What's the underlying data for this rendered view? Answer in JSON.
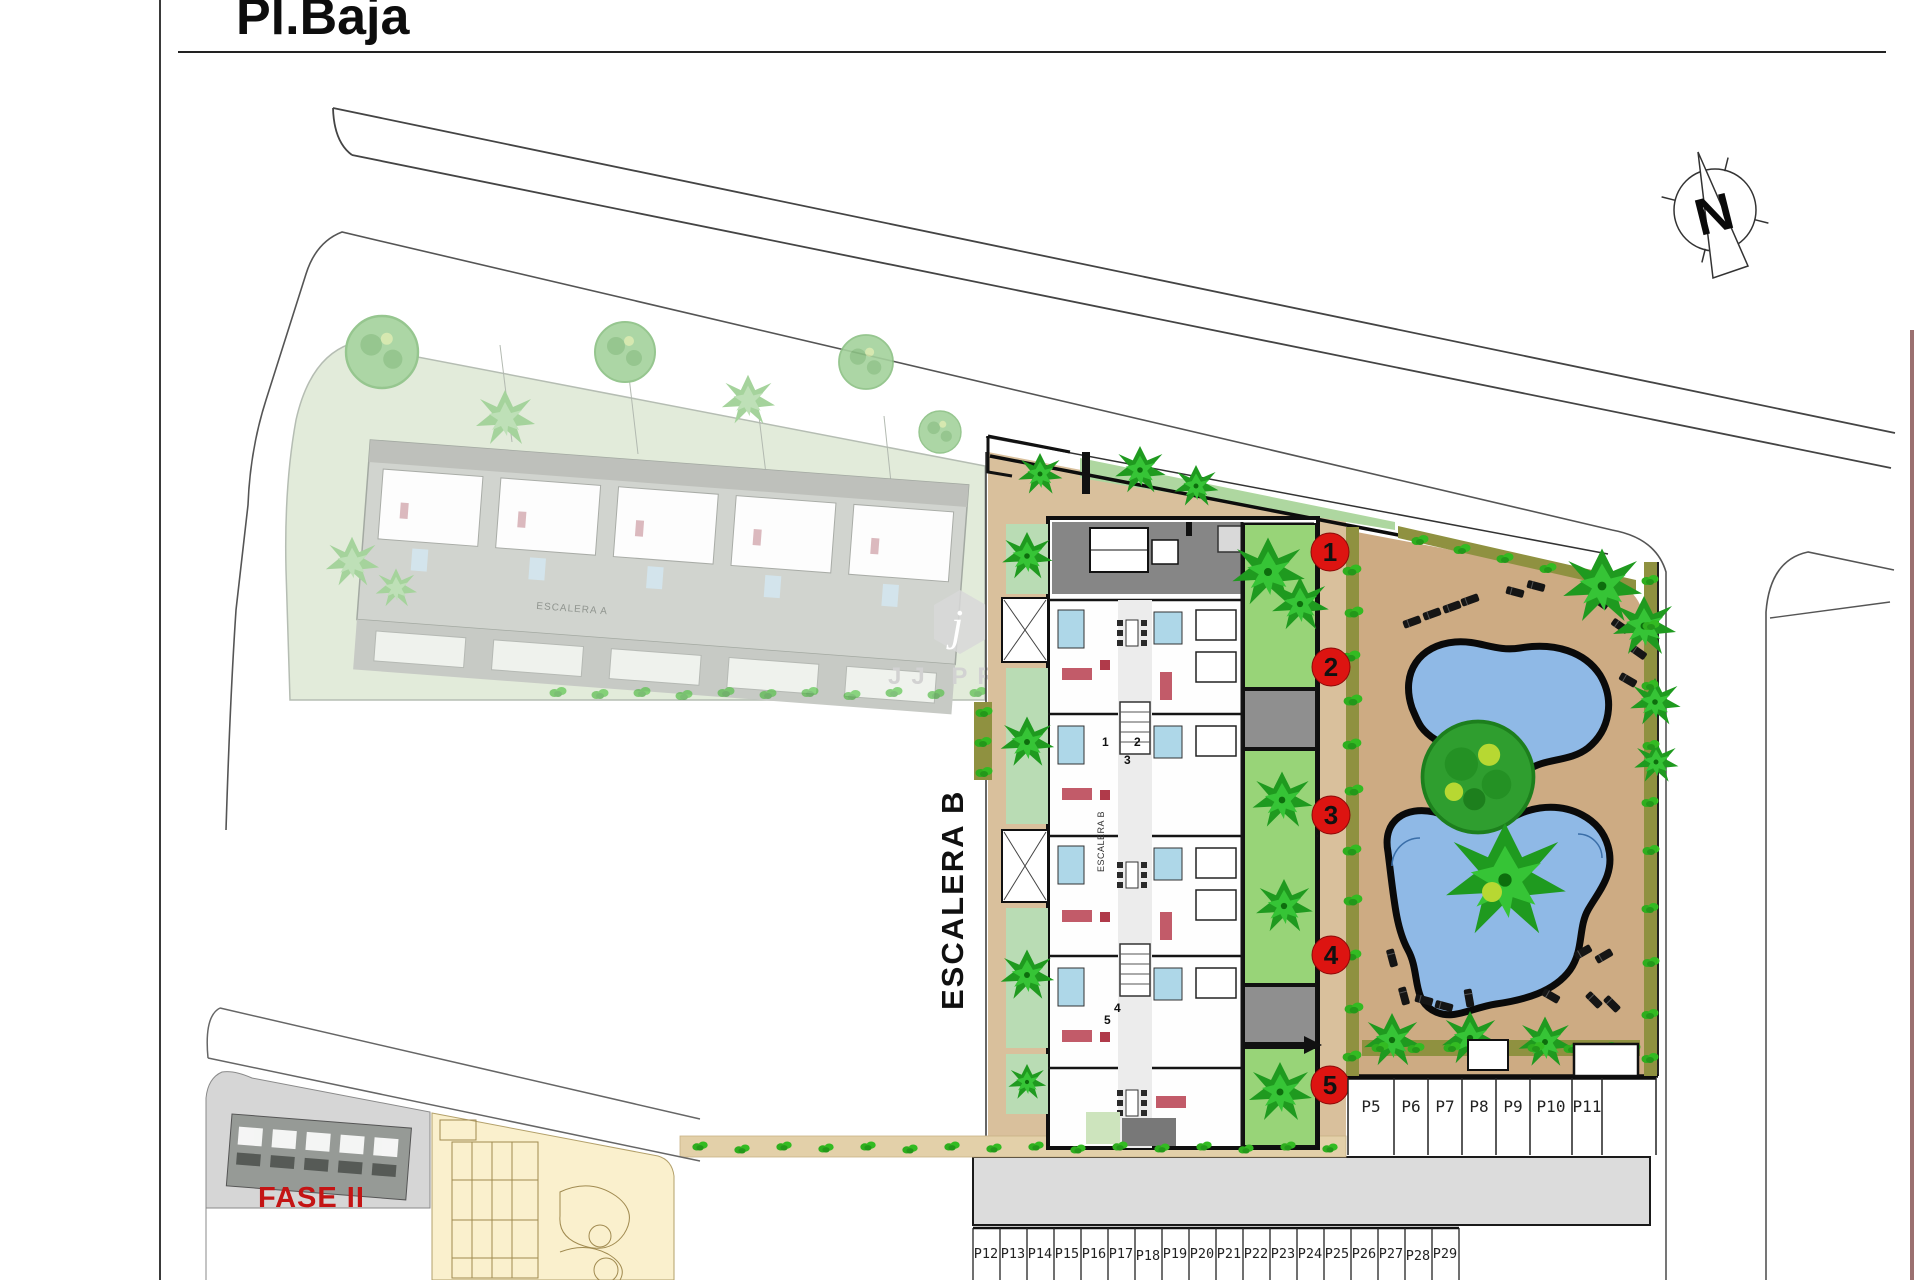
{
  "page": {
    "title": "Pl.Baja"
  },
  "compass": {
    "label": "N"
  },
  "watermark": {
    "logo": "j",
    "brand": "JJ PROPERTIES"
  },
  "labels": {
    "escalera_b": "ESCALERA B",
    "escalera_b_small": "ESCALERA B",
    "escalera_a": "ESCALERA A",
    "fase": "FASE II"
  },
  "entrances": [
    {
      "n": "1"
    },
    {
      "n": "2"
    },
    {
      "n": "3"
    },
    {
      "n": "4"
    },
    {
      "n": "5"
    }
  ],
  "units": [
    {
      "n": "1"
    },
    {
      "n": "2"
    },
    {
      "n": "3"
    },
    {
      "n": "4"
    },
    {
      "n": "5"
    }
  ],
  "parking": {
    "upper_row": [
      "P5",
      "P6",
      "P7",
      "P8",
      "P9",
      "P10",
      "P11"
    ],
    "lower_row": [
      "P12",
      "P13",
      "P14",
      "P15",
      "P16",
      "P17",
      "P18",
      "P19",
      "P20",
      "P21",
      "P22",
      "P23",
      "P24",
      "P25",
      "P26",
      "P27",
      "P28",
      "P29"
    ]
  },
  "colors": {
    "sand": "#cdab83",
    "sand_light": "#d9c09c",
    "pool_water": "#8fb9e6",
    "hedge_olive": "#8f9140",
    "garden_green": "#98d478",
    "lawn_green": "#b9dcb4",
    "tree_green": "#22a122",
    "marker_red": "#dd1411",
    "fase_red": "#c41414",
    "road_gray": "#dcdcdc",
    "phase_yellow": "#faf0cd",
    "border_pink": "#9b7070"
  }
}
